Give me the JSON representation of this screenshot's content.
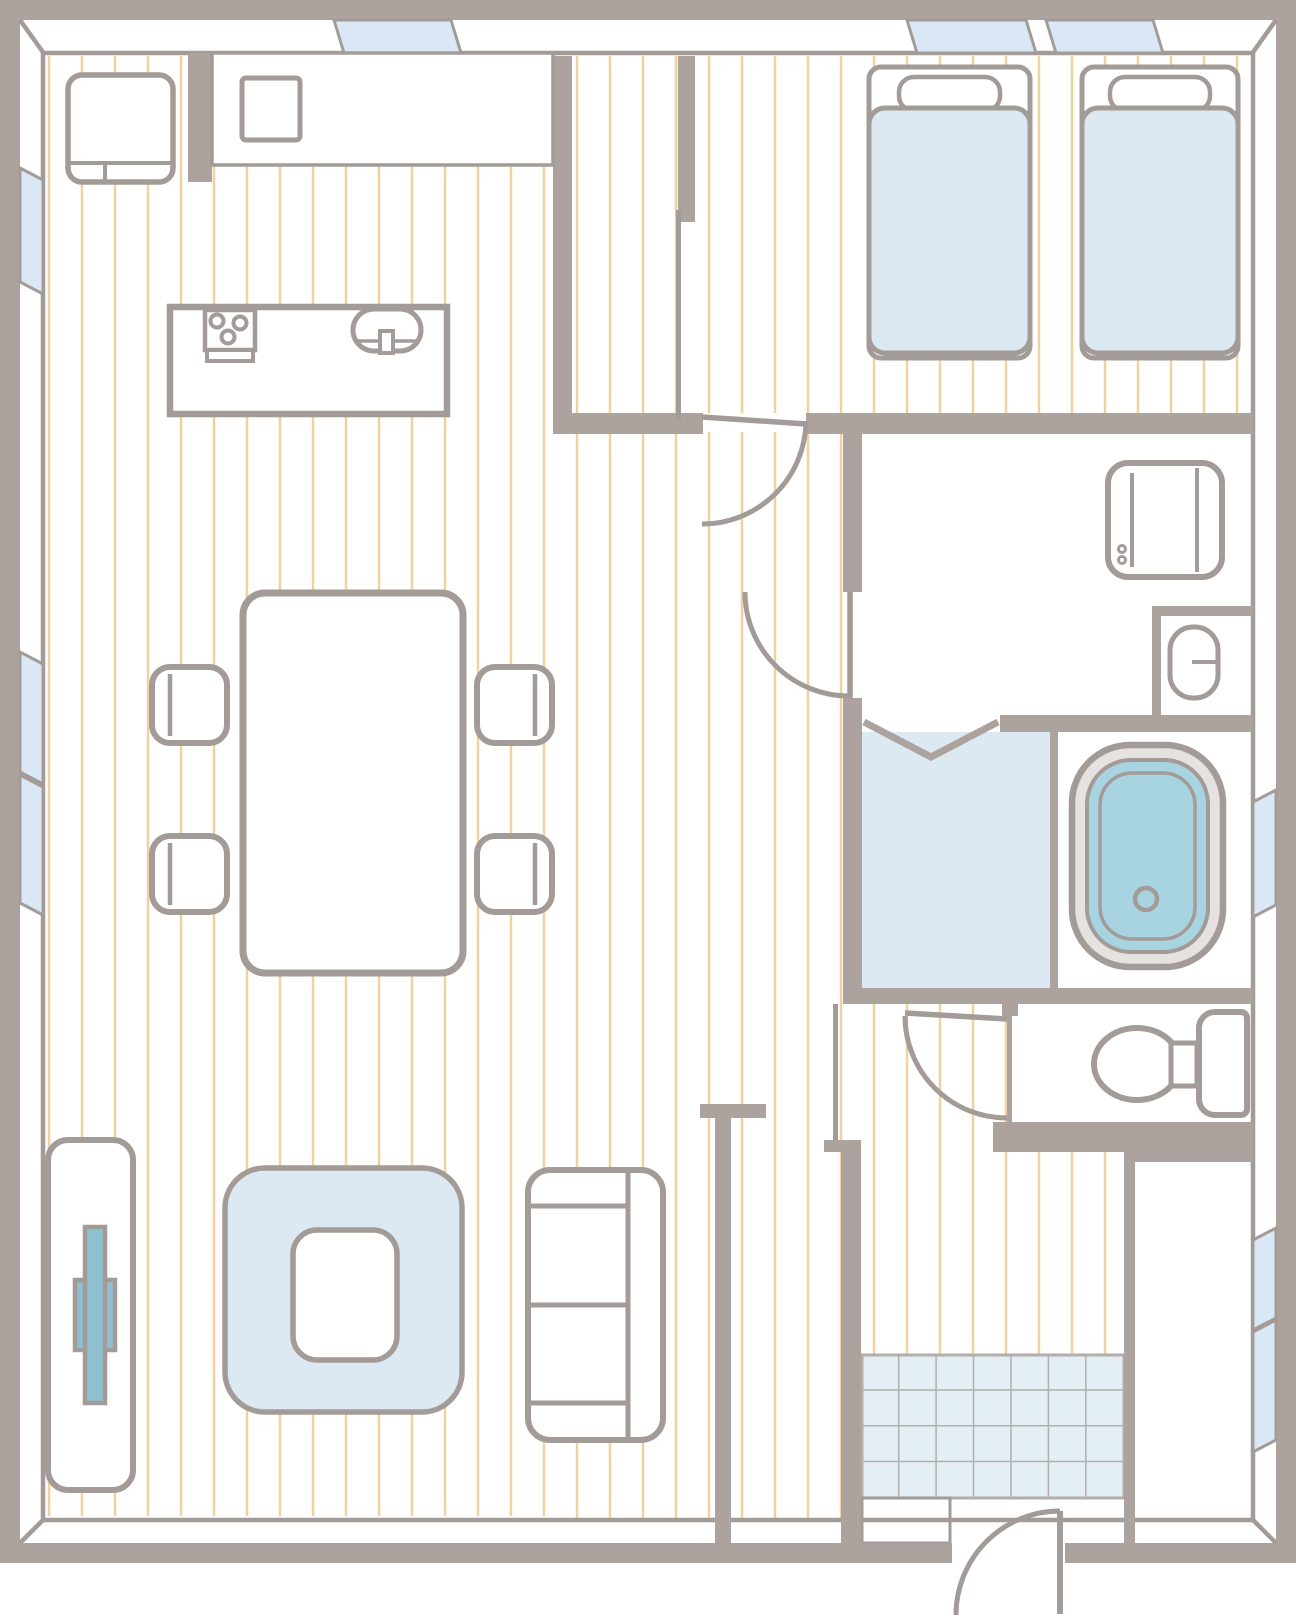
{
  "meta": {
    "kind": "architectural-floor-plan",
    "canvas_width_px": 1296,
    "canvas_height_px": 1616,
    "visible_text": "none"
  },
  "colors": {
    "wall": "#aca39f",
    "line": "#a39b97",
    "wood_line": "#efd2a0",
    "window": "#d9e8f4",
    "softblue": "#dce9f2",
    "tile": "#e4eef5",
    "tile_line": "#b2aeab",
    "water": "#a7d4e0",
    "tv": "#8fc0d2",
    "tub_rim": "#e5e2df",
    "floor": "#ffffff"
  },
  "rooms": [
    {
      "id": "ldk",
      "name": "living-dining-kitchen",
      "floor": "wood-strips"
    },
    {
      "id": "closet",
      "name": "walk-in-closet",
      "floor": "wood-strips"
    },
    {
      "id": "bedroom",
      "name": "bedroom-twin",
      "floor": "wood-strips"
    },
    {
      "id": "laundry",
      "name": "laundry-washroom",
      "floor": "plain"
    },
    {
      "id": "vanity",
      "name": "vanity-sink-nook",
      "floor": "plain"
    },
    {
      "id": "bathroom",
      "name": "bathroom-washing-area",
      "floor": "blue"
    },
    {
      "id": "bathtub_room",
      "name": "bathtub-area",
      "floor": "plain"
    },
    {
      "id": "toilet",
      "name": "toilet-room",
      "floor": "plain"
    },
    {
      "id": "hallway",
      "name": "hallway",
      "floor": "wood-strips"
    },
    {
      "id": "genkan",
      "name": "entrance-genkan",
      "floor": "tile-grid-7x4"
    },
    {
      "id": "entry_closet",
      "name": "entrance-storage-closet",
      "floor": "plain"
    }
  ],
  "furniture": {
    "kitchen": [
      "refrigerator",
      "wall-counter",
      "counter-sink-square",
      "island-counter",
      "stove-3-burners",
      "island-sink-with-faucet"
    ],
    "dining": [
      "dining-table",
      "chair x4"
    ],
    "living": [
      "tv-board",
      "tv",
      "rug",
      "low-table",
      "sofa-2-seat"
    ],
    "bedroom": [
      "single-bed x2 (headboard, pillow, duvet)"
    ],
    "laundry": [
      "washing-machine"
    ],
    "vanity": [
      "oval-sink-with-faucet"
    ],
    "bathroom": [
      "bathtub-with-drain"
    ],
    "toilet": [
      "toilet-bowl-with-tank"
    ]
  },
  "windows": [
    {
      "wall": "top",
      "at": "kitchen"
    },
    {
      "wall": "top",
      "at": "bedroom-1"
    },
    {
      "wall": "top",
      "at": "bedroom-2"
    },
    {
      "wall": "left",
      "at": "kitchen"
    },
    {
      "wall": "left",
      "at": "dining-upper"
    },
    {
      "wall": "left",
      "at": "dining-lower"
    },
    {
      "wall": "right",
      "at": "bathtub"
    },
    {
      "wall": "right",
      "at": "entry-closet-upper"
    },
    {
      "wall": "right",
      "at": "entry-closet-lower"
    }
  ],
  "doors": [
    {
      "room": "bedroom",
      "type": "hinged-swing"
    },
    {
      "room": "laundry",
      "type": "hinged-swing"
    },
    {
      "room": "bathroom",
      "type": "bi-fold"
    },
    {
      "room": "toilet",
      "type": "hinged-swing"
    },
    {
      "room": "entrance",
      "type": "hinged-swing-outward"
    },
    {
      "room": "walk-in-closet",
      "type": "sliding-panel"
    }
  ],
  "counts": {
    "beds": 2,
    "dining_chairs": 4,
    "stove_burners": 3,
    "tile_columns": 7,
    "tile_rows": 4,
    "windows": 9,
    "doors": 6
  }
}
